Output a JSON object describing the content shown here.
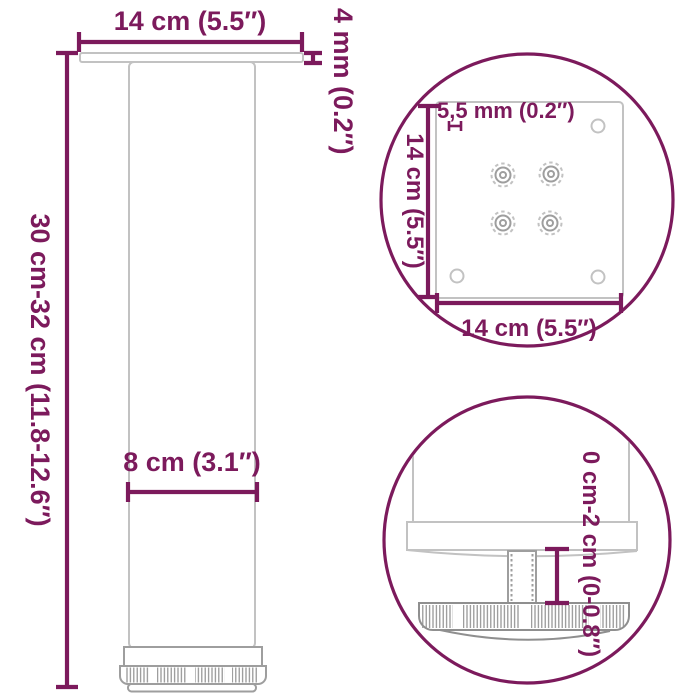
{
  "diagram": {
    "accent_color": "#7c1a5c",
    "product_line_light": "#c2c2c2",
    "product_line_dark": "#8f8f8f",
    "background": "#ffffff",
    "side_view": {
      "plate_width_label": "14 cm (5.5″)",
      "plate_thickness_label": "4 mm (0.2″)",
      "height_label": "30 cm-32 cm (11.8-12.6″)",
      "tube_diameter_label": "8 cm (3.1″)"
    },
    "plate_top_view": {
      "hole_diameter_label": "5,5 mm (0.2″)",
      "plate_depth_label": "14 cm (5.5″)",
      "plate_width_label": "14 cm (5.5″)"
    },
    "foot_detail_view": {
      "height_adjustment_label": "0 cm-2 cm (0-0.8″)"
    }
  }
}
